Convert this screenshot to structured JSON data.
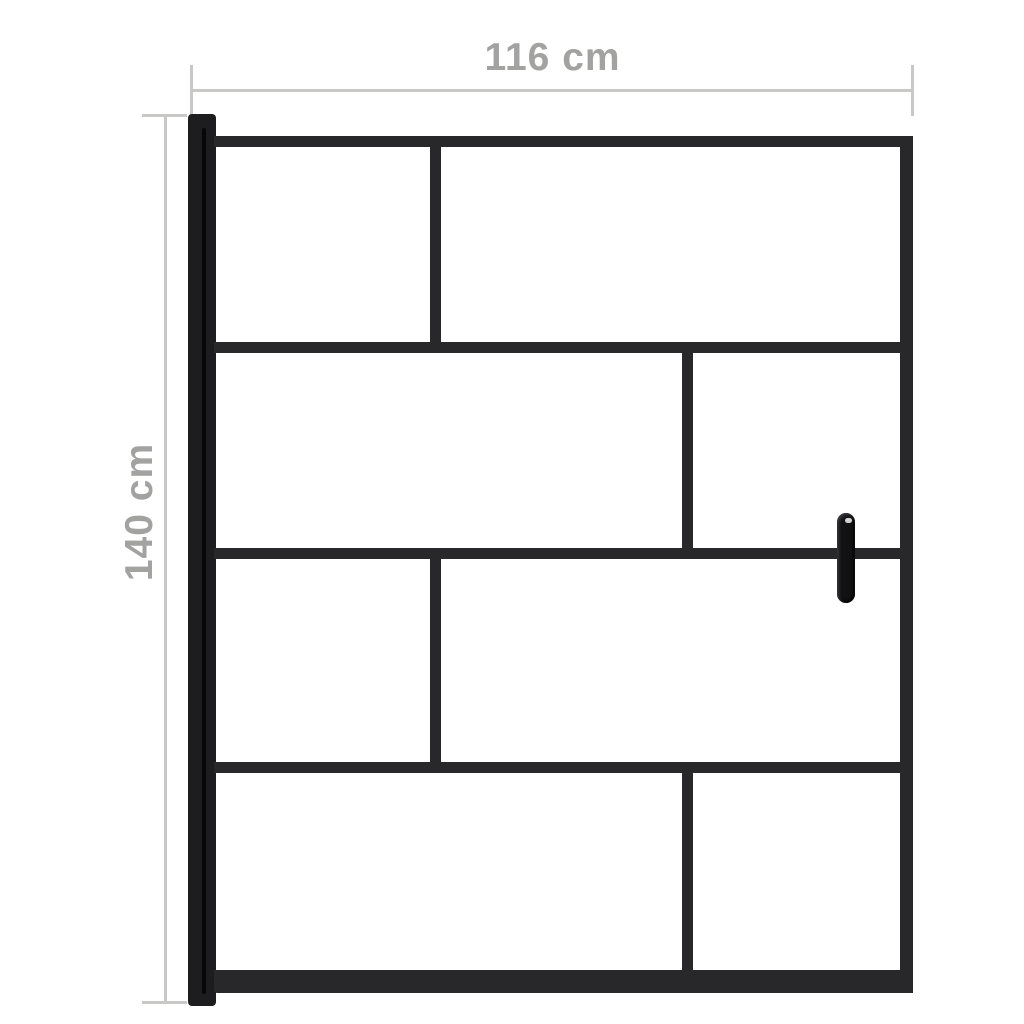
{
  "diagram": {
    "type": "product-dimension-diagram",
    "subject": "black framed glass shower screen with vertical handle"
  },
  "dimensions": {
    "width_label": "116 cm",
    "height_label": "140 cm"
  },
  "colors": {
    "background": "#ffffff",
    "frame_black": "#28282b",
    "profile_black": "#1d1d1f",
    "profile_stripe": "#070708",
    "handle_black": "#121214",
    "dimension_line_gray": "#c8c8c7",
    "dimension_text_gray": "#a2a2a1"
  }
}
